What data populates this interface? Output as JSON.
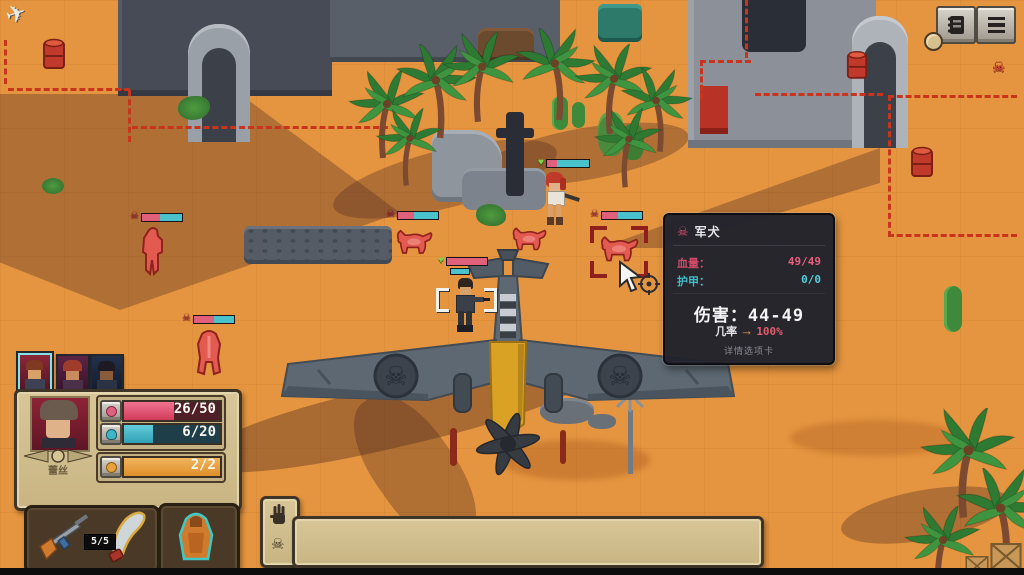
{
  "icons": {
    "skull": "☠",
    "heart": "♥",
    "check": "✔",
    "move_cross": "⊕",
    "advance_arrow": "→",
    "cancel_circle": "⊖",
    "plane_marker": "✈"
  },
  "map_markers": {
    "objective_plane": "plane-marker-top-left",
    "enemy_alert": "red-skull-marker-top-right"
  },
  "top_right_toolbar": {
    "journal_button": "journal",
    "menu_button": "menu"
  },
  "tooltip": {
    "title": "军犬",
    "hp_label": "血量：",
    "hp_value": "49/49",
    "armor_label": "护甲：",
    "armor_value": "0/0",
    "damage_label": "伤害：",
    "damage_value": "44-49",
    "chance_label": "几率",
    "chance_arrow": "→",
    "chance_value": "100%",
    "footer": "详情选项卡"
  },
  "party_bar": {
    "member_count": 3,
    "selected_index": 0
  },
  "character_panel": {
    "name": "蕾丝",
    "hp_display": "26/50",
    "hp_pct": 52,
    "energy_display": "6/20",
    "energy_pct": 30,
    "action_display": "2/2",
    "action_pct": 100
  },
  "weapon_panel": {
    "ammo": "5/5",
    "slots": [
      "rifle",
      "machete"
    ],
    "gear_slot": "poncho"
  },
  "action_bar": {
    "buttons": [
      {
        "name": "aimed-shot",
        "enabled": true
      },
      {
        "name": "precise-shot",
        "enabled": true
      },
      {
        "name": "knife-attack",
        "enabled": true
      },
      {
        "name": "heavy-melee",
        "enabled": true
      },
      {
        "name": "overwatch",
        "enabled": true
      },
      {
        "name": "move",
        "enabled": true
      },
      {
        "name": "sprint",
        "enabled": true
      },
      {
        "name": "swap-character",
        "enabled": false
      },
      {
        "name": "heal-syringe",
        "enabled": true
      },
      {
        "name": "end-turn",
        "enabled": true
      }
    ]
  },
  "scene": {
    "units": [
      {
        "name": "ally-soldier-selected"
      },
      {
        "name": "ally-rifle-woman"
      },
      {
        "name": "enemy-infantry"
      },
      {
        "name": "enemy-dog-1"
      },
      {
        "name": "enemy-dog-2"
      },
      {
        "name": "enemy-dog-targeted"
      },
      {
        "name": "enemy-dog-rear"
      }
    ]
  },
  "colors": {
    "sand": "#e5953f",
    "tooltip_bg": "#21222c",
    "hp_red": "#e25572",
    "energy_blue": "#3eb6c8",
    "action_orange": "#e8a13c",
    "enemy_red": "#e0504a",
    "ally_green": "#7ed64a"
  }
}
